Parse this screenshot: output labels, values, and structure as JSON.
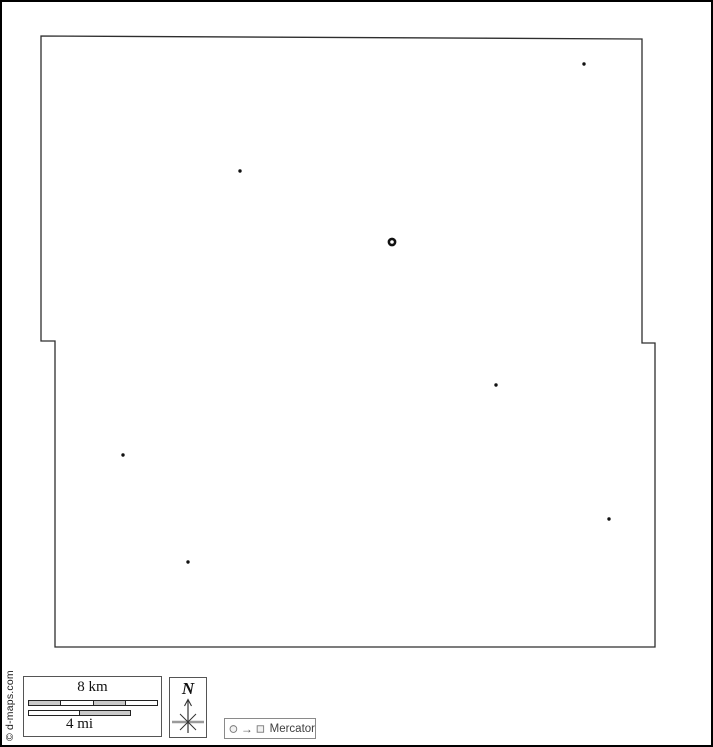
{
  "copyright": {
    "text": "© d-maps.com"
  },
  "map": {
    "background": "#ffffff",
    "outline_color": "#2e2e2e",
    "boundary_points": "41,36 642,39 642,343 655,343 655,647 55,647 55,341 41,341",
    "city_dots": [
      {
        "x": 584,
        "y": 64
      },
      {
        "x": 240,
        "y": 171
      },
      {
        "x": 496,
        "y": 385
      },
      {
        "x": 123,
        "y": 455
      },
      {
        "x": 609,
        "y": 519
      },
      {
        "x": 188,
        "y": 562
      }
    ],
    "capital_ring": {
      "x": 392,
      "y": 242,
      "r": 3.1,
      "stroke_width": 2.6
    },
    "dot_radius": 1.7,
    "dot_color": "#111111"
  },
  "scale_bar": {
    "km_label": "8 km",
    "mi_label": "4 mi",
    "segment_fill": "#c9c9c9"
  },
  "compass": {
    "north_label": "N"
  },
  "legend": {
    "projection_label": "Mercator"
  }
}
